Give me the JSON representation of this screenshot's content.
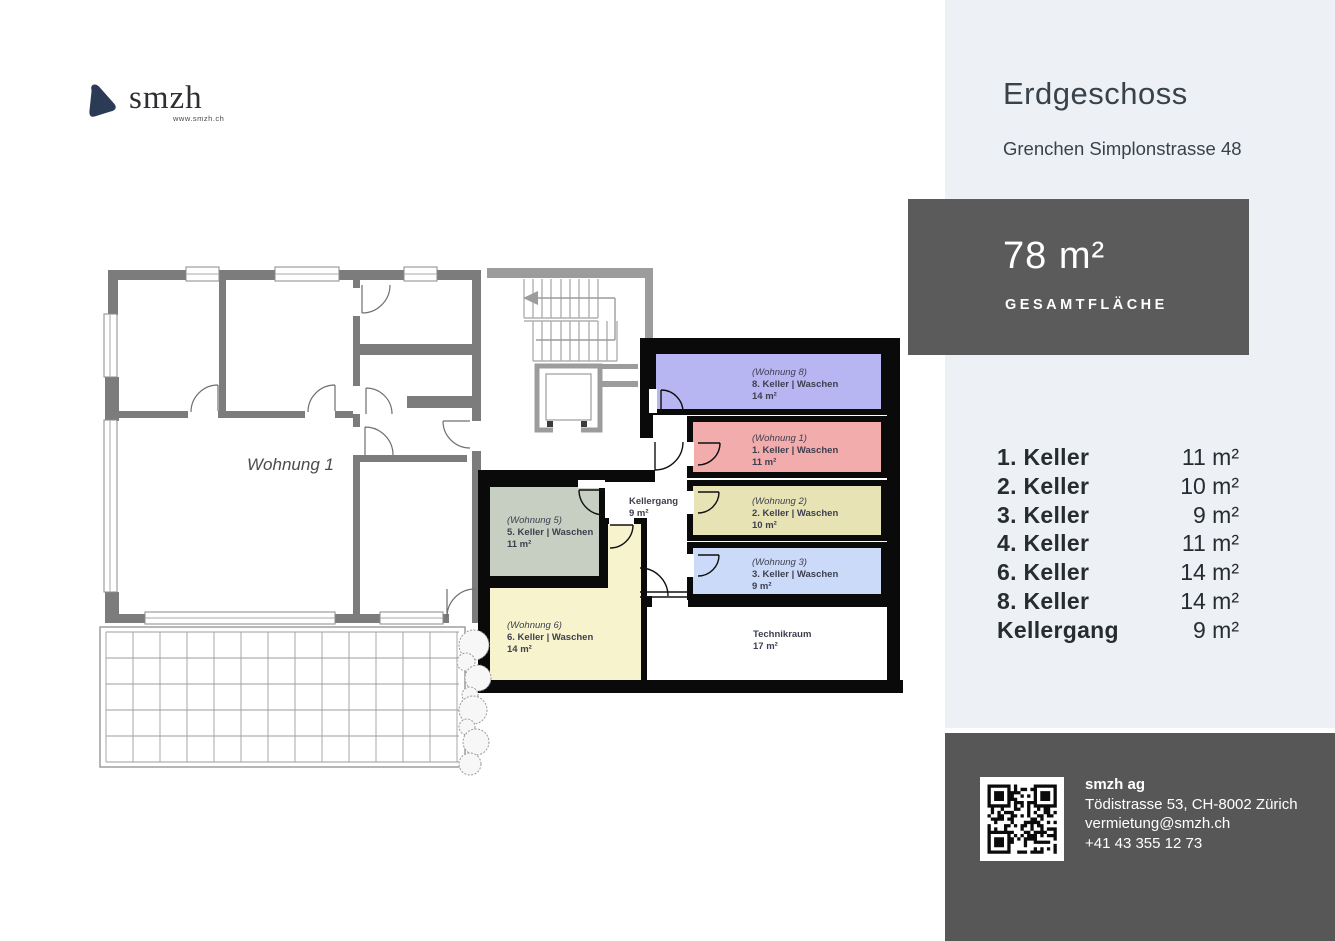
{
  "logo": {
    "brand": "smzh",
    "website": "www.smzh.ch"
  },
  "sidebar": {
    "title": "Erdgeschoss",
    "subtitle": "Grenchen Simplonstrasse 48",
    "area_box": {
      "value": "78 m²",
      "label": "GESAMTFLÄCHE"
    },
    "rooms": [
      {
        "label": "1. Keller",
        "area": "11 m²"
      },
      {
        "label": "2. Keller",
        "area": "10 m²"
      },
      {
        "label": "3. Keller",
        "area": "9 m²"
      },
      {
        "label": "4. Keller",
        "area": "11 m²"
      },
      {
        "label": "6. Keller",
        "area": "14 m²"
      },
      {
        "label": "8. Keller",
        "area": "14 m²"
      },
      {
        "label": "Kellergang",
        "area": "9 m²"
      }
    ]
  },
  "footer": {
    "company": "smzh ag",
    "address": "Tödistrasse 53, CH-8002 Zürich",
    "email": "vermietung@smzh.ch",
    "phone": "+41 43 355 12 73"
  },
  "floorplan": {
    "apartment_label": "Wohnung 1",
    "corridor": {
      "name": "Kellergang",
      "area": "9 m²"
    },
    "technik": {
      "name": "Technikraum",
      "area": "17 m²"
    },
    "cellars": [
      {
        "unit": "(Wohnung 8)",
        "name": "8. Keller | Waschen",
        "area": "14 m²",
        "color": "#b8b5f3"
      },
      {
        "unit": "(Wohnung 1)",
        "name": "1. Keller | Waschen",
        "area": "11 m²",
        "color": "#f2acac"
      },
      {
        "unit": "(Wohnung 2)",
        "name": "2. Keller | Waschen",
        "area": "10 m²",
        "color": "#e7e3b5"
      },
      {
        "unit": "(Wohnung 3)",
        "name": "3. Keller | Waschen",
        "area": "9 m²",
        "color": "#cadaf8"
      },
      {
        "unit": "(Wohnung 5)",
        "name": "5. Keller | Waschen",
        "area": "11 m²",
        "color": "#c6cfc1"
      },
      {
        "unit": "(Wohnung 6)",
        "name": "6. Keller | Waschen",
        "area": "14 m²",
        "color": "#f7f3cd"
      }
    ]
  },
  "colors": {
    "sidebar_bg": "#edf1f5",
    "panel_bg": "#5c5b5b",
    "footer_bg": "#585757",
    "heading_text": "#39414a",
    "logo_icon": "#2b3a55",
    "apartment_wall": "#7c7c7c",
    "stair_wall": "#9c9c9c",
    "cellar_wall": "#0a0a0a"
  }
}
